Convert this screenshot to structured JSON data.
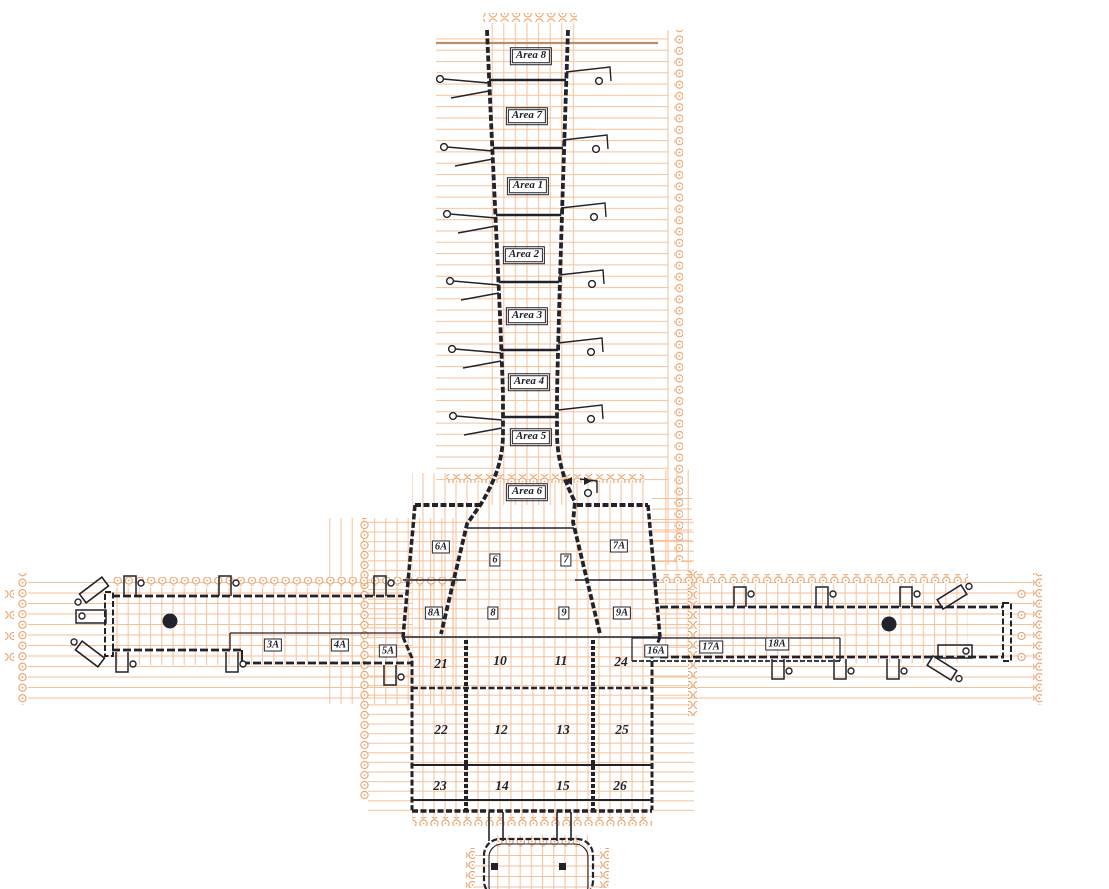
{
  "drawing": {
    "areas": [
      "Area 8",
      "Area 7",
      "Area 1",
      "Area 2",
      "Area 3",
      "Area 4",
      "Area 5",
      "Area 6"
    ],
    "boxed_zones": [
      "6A",
      "7A",
      "6",
      "7",
      "8A",
      "8",
      "9",
      "9A",
      "3A",
      "4A",
      "5A",
      "16A",
      "17A",
      "18A"
    ],
    "room_numbers": [
      "21",
      "10",
      "11",
      "24",
      "22",
      "12",
      "13",
      "25",
      "23",
      "14",
      "15",
      "26"
    ],
    "colors": {
      "grid": "#f5c199",
      "bubble": "#eba26a",
      "ink": "#22222b",
      "accent": "#b5906a"
    }
  }
}
